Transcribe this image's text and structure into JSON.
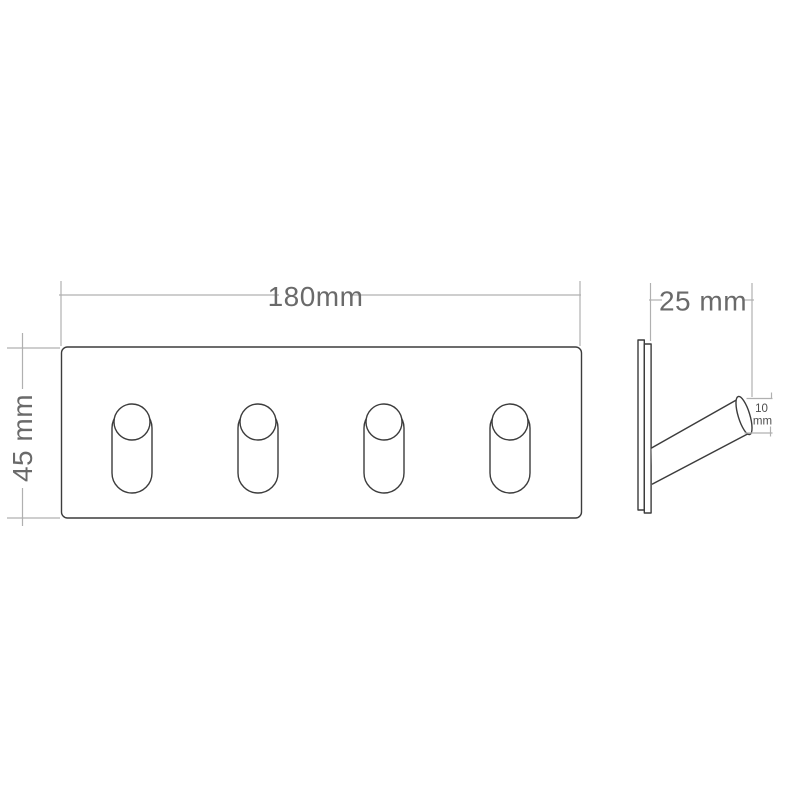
{
  "drawing": {
    "type": "technical-dimension-drawing",
    "subject": "wall hook rail with 4 pegs, front and side views",
    "background_color": "#ffffff",
    "object_line_color": "#3c3c3c",
    "dimension_line_color": "#b0b0b0",
    "dimension_text_color": "#6a6a6a",
    "small_text_color": "#4d4d4d",
    "front_view": {
      "width_label": "180mm",
      "height_label": "45 mm",
      "hook_count": 4
    },
    "side_view": {
      "depth_label": "25 mm",
      "hook_diameter_label_line1": "10",
      "hook_diameter_label_line2": "mm"
    }
  }
}
